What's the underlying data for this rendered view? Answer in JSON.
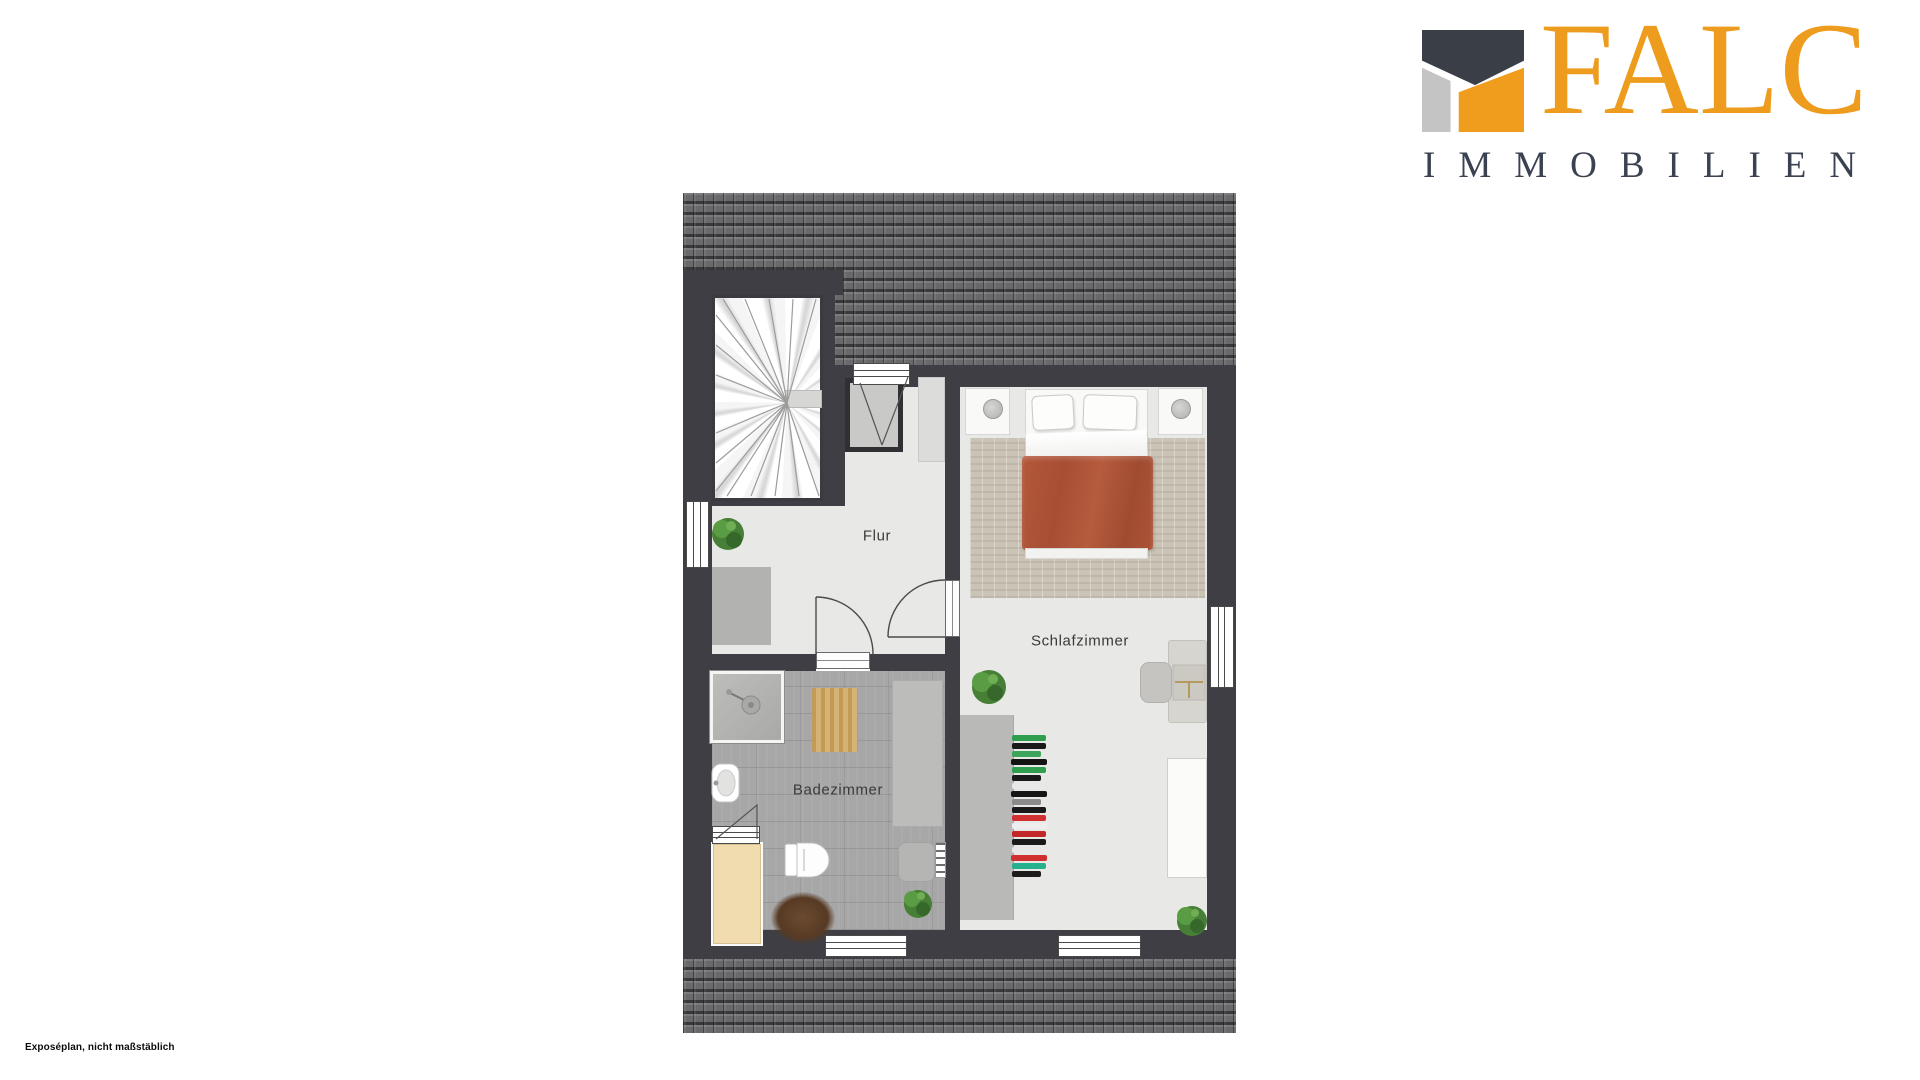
{
  "logo": {
    "brand": "FALC",
    "subtitle": "IMMOBILIEN",
    "colors": {
      "orange": "#EE9C1E",
      "dark_slate": "#3A4150",
      "gray": "#C4C4C4",
      "mark_dark": "#3A3F47"
    }
  },
  "footer": {
    "note": "Exposéplan, nicht maßstäblich"
  },
  "rooms": {
    "flur": {
      "label": "Flur"
    },
    "schlafzimmer": {
      "label": "Schlafzimmer"
    },
    "badezimmer": {
      "label": "Badezimmer"
    }
  },
  "floorplan": {
    "colors": {
      "wall": "#3E3E44",
      "roof": "#69696C",
      "floor_light": "#E8E8E6",
      "floor_tile": "#A7A7A7",
      "rug_bedroom": "#CBC4B6",
      "rug_bath": "#D5B276",
      "bed_duvet": "#AC5036",
      "bathtub": "#F1DCB0",
      "plant_green": "#467F35"
    },
    "wardrobe_items": [
      "#2F9E4F",
      "#1A1A1A",
      "#3DA55A",
      "#141414",
      "#2F9E4F",
      "#1A1A1A",
      "#E8E8E8",
      "#161616",
      "#8A8A8A",
      "#1A1A1A",
      "#D03030",
      "#EDEDED",
      "#C22828",
      "#1A1A1A",
      "#E6E6E6",
      "#CF2F2F",
      "#26B08C",
      "#1C1C1C"
    ]
  }
}
